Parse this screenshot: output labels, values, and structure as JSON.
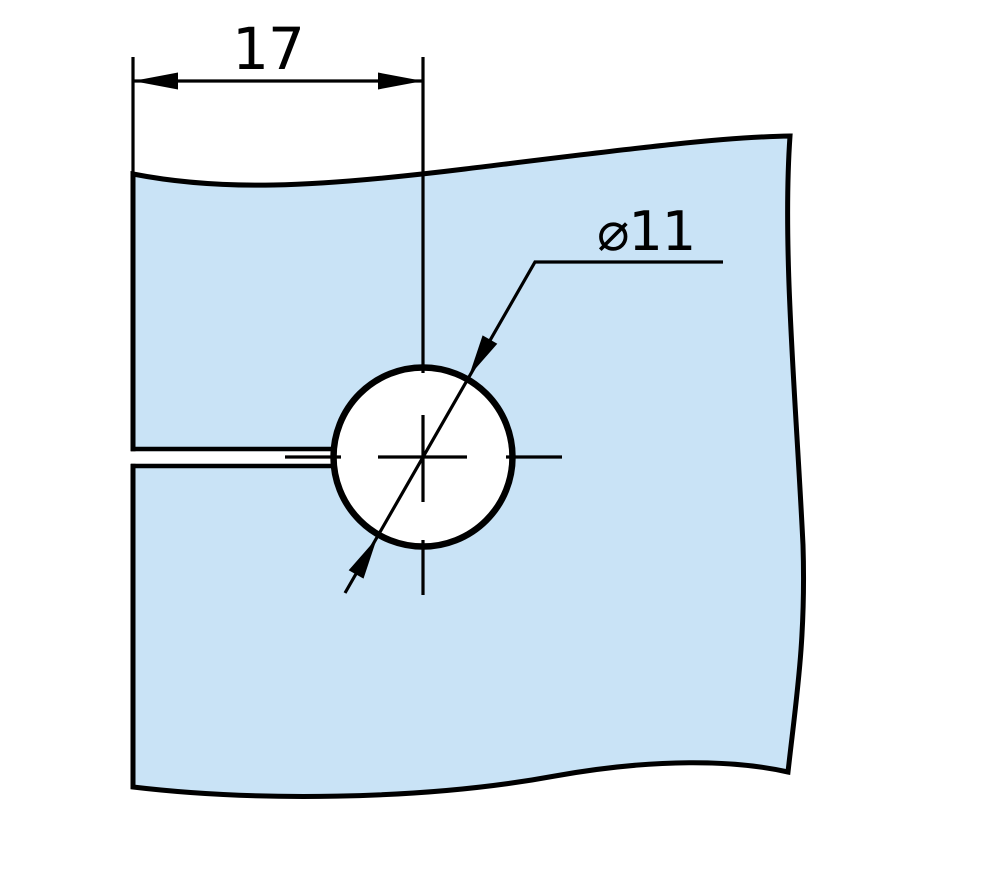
{
  "drawing": {
    "type": "technical-drawing",
    "part": "plate-with-slot-and-hole",
    "dimensions": [
      {
        "id": "slot_offset_width",
        "label": "17"
      },
      {
        "id": "hole_diameter",
        "label": "⌀11"
      }
    ],
    "colors": {
      "plate_fill": "#c9e3f6",
      "line_color": "#000000",
      "hole_fill": "#ffffff",
      "background": "#ffffff"
    }
  }
}
